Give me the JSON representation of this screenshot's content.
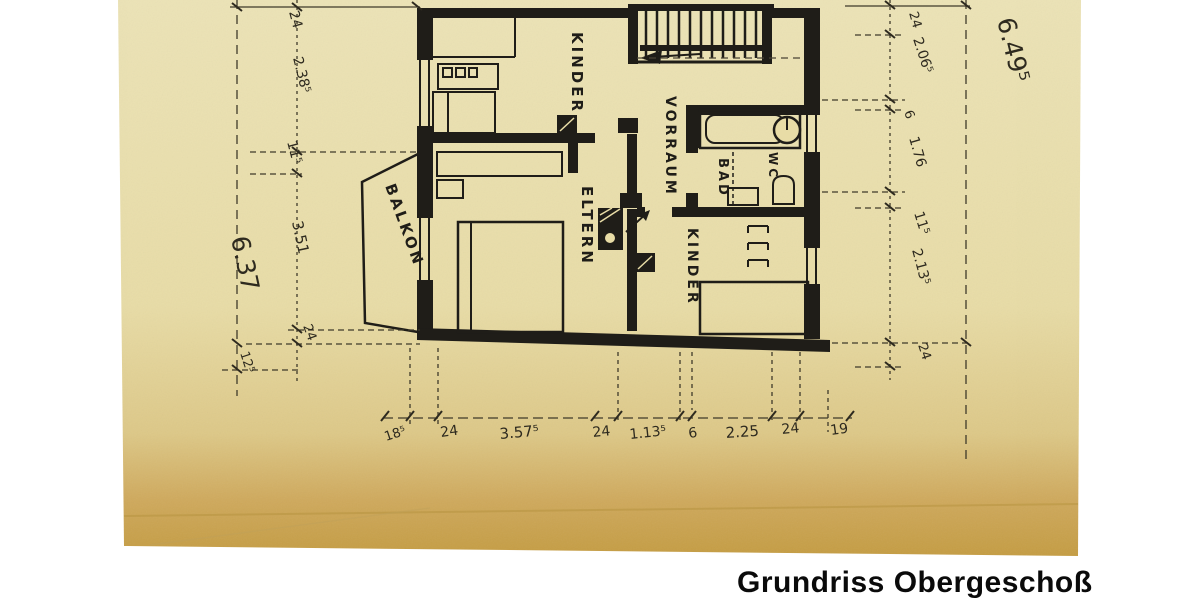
{
  "caption": "Grundriss Obergeschoß",
  "rooms": {
    "kinder_top": "KINDER",
    "eltern": "ELTERN",
    "vorraum": "VORRAUM",
    "bad": "BAD",
    "wc": "WC",
    "kinder_bottom": "KINDER",
    "balkon": "BALKON"
  },
  "dims": {
    "left": [
      "24",
      "2.38⁵",
      "11⁵",
      "3.51",
      "24",
      "12⁵"
    ],
    "left_total": "6.37",
    "right": [
      "24",
      "2.06⁵",
      "6",
      "1.76",
      "11⁵",
      "2.13⁵",
      "24"
    ],
    "right_total": "6.49⁵",
    "bottom": [
      "18⁵",
      "24",
      "3.57⁵",
      "24",
      "1.13⁵",
      "6",
      "2.25",
      "24",
      "19"
    ]
  },
  "colors": {
    "paper": "#e9dfae",
    "paper_bottom": "#c49c42",
    "ink": "#1f1d18",
    "caption_text": "#0a0a0a",
    "background": "#ffffff"
  }
}
